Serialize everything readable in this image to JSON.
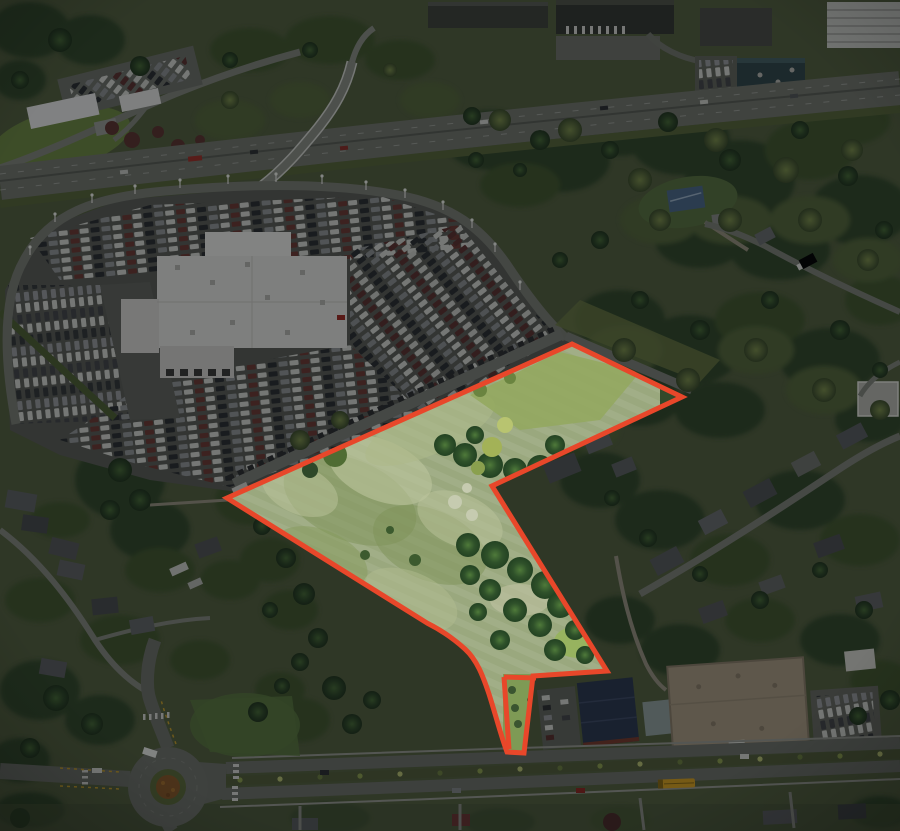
{
  "image": {
    "type": "oblique-aerial-photograph",
    "subject": "land parcel highlighted with red boundary outline; surroundings darkened",
    "width_px": 900,
    "height_px": 831
  },
  "overlay": {
    "color": "#06080a",
    "opacity": "0.47"
  },
  "parcel": {
    "boundary_color": "#e8472a",
    "boundary_width": "5",
    "boundary_path": "M 572,344 L 682,397 L 492,486 L 607,671 L 533,676 L 524,753 L 507,752 C 501,736 496,716 489,694 C 483,676 477,660 465,649 C 454,639 441,630 427,623 L 227,498 Z",
    "access_segments": [
      "M 504,677 L 536,678",
      "M 504,677 L 509,749"
    ]
  },
  "scene": {
    "regions": [
      "highlighted-land-parcel",
      "car-dealership-lot",
      "dealership-building",
      "interstate-freeway",
      "freeway-overpass",
      "church-campus",
      "industrial-warehouses",
      "office-building",
      "teal-office-building",
      "suburban-homes-west",
      "suburban-homes-east",
      "commercial-buildings-south",
      "arterial-road",
      "roundabout",
      "school-bus",
      "forest-canopy"
    ]
  }
}
